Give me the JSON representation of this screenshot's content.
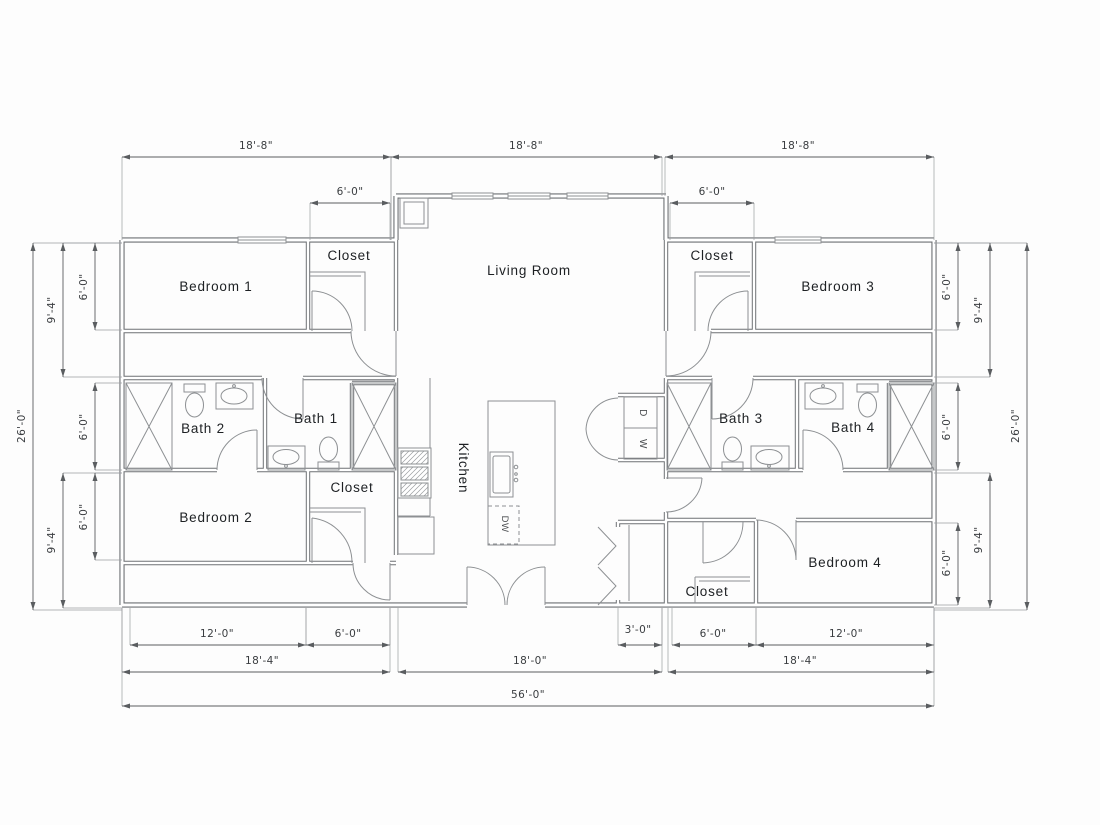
{
  "drawing": {
    "type": "floor-plan",
    "units": "feet-inches",
    "overall_width": "56'-0\"",
    "overall_depth": "26'-0\""
  },
  "colors": {
    "background": "#fdfdfd",
    "wall": "#6e7174",
    "fixture": "#8d9093",
    "door": "#8d9093",
    "dim_line": "#5a5d60",
    "ext_line": "#9a9da0",
    "room_text": "#1d2023",
    "dim_text": "#3a3d40"
  },
  "rooms": [
    {
      "name": "bedroom-1",
      "label": "Bedroom 1",
      "tx": 216,
      "ty": 291,
      "rot": 0
    },
    {
      "name": "closet-bedroom-1",
      "label": "Closet",
      "tx": 349,
      "ty": 260,
      "rot": 0
    },
    {
      "name": "living-room",
      "label": "Living Room",
      "tx": 529,
      "ty": 275,
      "rot": 0
    },
    {
      "name": "closet-bedroom-3",
      "label": "Closet",
      "tx": 712,
      "ty": 260,
      "rot": 0
    },
    {
      "name": "bedroom-3",
      "label": "Bedroom 3",
      "tx": 838,
      "ty": 291,
      "rot": 0
    },
    {
      "name": "bath-2",
      "label": "Bath 2",
      "tx": 203,
      "ty": 433,
      "rot": 0
    },
    {
      "name": "bath-1",
      "label": "Bath 1",
      "tx": 316,
      "ty": 423,
      "rot": 0
    },
    {
      "name": "bath-3",
      "label": "Bath 3",
      "tx": 741,
      "ty": 423,
      "rot": 0
    },
    {
      "name": "bath-4",
      "label": "Bath 4",
      "tx": 853,
      "ty": 432,
      "rot": 0
    },
    {
      "name": "kitchen",
      "label": "Kitchen",
      "tx": 459,
      "ty": 468,
      "rot": 90
    },
    {
      "name": "bedroom-2",
      "label": "Bedroom 2",
      "tx": 216,
      "ty": 522,
      "rot": 0
    },
    {
      "name": "closet-bedroom-2",
      "label": "Closet",
      "tx": 352,
      "ty": 492,
      "rot": 0
    },
    {
      "name": "closet-bedroom-4",
      "label": "Closet",
      "tx": 707,
      "ty": 596,
      "rot": 0
    },
    {
      "name": "bedroom-4",
      "label": "Bedroom 4",
      "tx": 845,
      "ty": 567,
      "rot": 0
    }
  ],
  "appliances": [
    {
      "name": "dryer",
      "label": "D",
      "tx": 640,
      "ty": 413,
      "rot": 90
    },
    {
      "name": "washer",
      "label": "W",
      "tx": 640,
      "ty": 444,
      "rot": 90
    },
    {
      "name": "dishwasher",
      "label": "DW",
      "tx": 502,
      "ty": 524,
      "rot": 90
    }
  ],
  "dimensions": [
    {
      "name": "top-left-wing",
      "label": "18'-8\"",
      "x1": 122,
      "y1": 157,
      "x2": 391,
      "y2": 157,
      "e1": 83,
      "e2": 83,
      "tx": 256,
      "ty": 149,
      "rot": 0
    },
    {
      "name": "top-center",
      "label": "18'-8\"",
      "x1": 391,
      "y1": 157,
      "x2": 662,
      "y2": 157,
      "e1": 83,
      "e2": 39,
      "tx": 526,
      "ty": 149,
      "rot": 0
    },
    {
      "name": "top-right-wing",
      "label": "18'-8\"",
      "x1": 665,
      "y1": 157,
      "x2": 934,
      "y2": 157,
      "e1": 39,
      "e2": 83,
      "tx": 798,
      "ty": 149,
      "rot": 0
    },
    {
      "name": "closet1-width",
      "label": "6'-0\"",
      "x1": 310,
      "y1": 203,
      "x2": 390,
      "y2": 203,
      "e1": 37,
      "e2": 37,
      "tx": 350,
      "ty": 195,
      "rot": 0
    },
    {
      "name": "closet3-width",
      "label": "6'-0\"",
      "x1": 670,
      "y1": 203,
      "x2": 754,
      "y2": 203,
      "e1": 37,
      "e2": 37,
      "tx": 712,
      "ty": 195,
      "rot": 0
    },
    {
      "name": "bedroom2-width",
      "label": "12'-0\"",
      "x1": 130,
      "y1": 645,
      "x2": 306,
      "y2": 645,
      "e1": -37,
      "e2": -37,
      "tx": 217,
      "ty": 637,
      "rot": 0
    },
    {
      "name": "closet2-width",
      "label": "6'-0\"",
      "x1": 306,
      "y1": 645,
      "x2": 390,
      "y2": 645,
      "e1": -37,
      "e2": -37,
      "tx": 348,
      "ty": 637,
      "rot": 0
    },
    {
      "name": "pantry-width",
      "label": "3'-0\"",
      "x1": 618,
      "y1": 645,
      "x2": 662,
      "y2": 645,
      "e1": -37,
      "e2": -37,
      "tx": 638,
      "ty": 633,
      "rot": 0
    },
    {
      "name": "closet4-width",
      "label": "6'-0\"",
      "x1": 672,
      "y1": 645,
      "x2": 756,
      "y2": 645,
      "e1": -37,
      "e2": -37,
      "tx": 713,
      "ty": 637,
      "rot": 0
    },
    {
      "name": "bedroom4-width",
      "label": "12'-0\"",
      "x1": 756,
      "y1": 645,
      "x2": 934,
      "y2": 645,
      "e1": -37,
      "e2": -37,
      "tx": 846,
      "ty": 637,
      "rot": 0
    },
    {
      "name": "left-wing-width",
      "label": "18'-4\"",
      "x1": 122,
      "y1": 672,
      "x2": 390,
      "y2": 672,
      "e1": -64,
      "e2": -64,
      "tx": 262,
      "ty": 664,
      "rot": 0
    },
    {
      "name": "center-width",
      "label": "18'-0\"",
      "x1": 398,
      "y1": 672,
      "x2": 662,
      "y2": 672,
      "e1": -64,
      "e2": -64,
      "tx": 530,
      "ty": 664,
      "rot": 0
    },
    {
      "name": "right-wing-width",
      "label": "18'-4\"",
      "x1": 668,
      "y1": 672,
      "x2": 934,
      "y2": 672,
      "e1": -64,
      "e2": -64,
      "tx": 800,
      "ty": 664,
      "rot": 0
    },
    {
      "name": "overall-width",
      "label": "56'-0\"",
      "x1": 122,
      "y1": 706,
      "x2": 934,
      "y2": 706,
      "e1": -98,
      "e2": -98,
      "tx": 528,
      "ty": 698,
      "rot": 0
    },
    {
      "name": "left-overall",
      "label": "26'-0\"",
      "x1": 33,
      "y1": 243,
      "x2": 33,
      "y2": 610,
      "e1": 89,
      "e2": 89,
      "tx": 25,
      "ty": 426,
      "rot": -90
    },
    {
      "name": "left-94-top",
      "label": "9'-4\"",
      "x1": 63,
      "y1": 243,
      "x2": 63,
      "y2": 377,
      "e1": 59,
      "e2": 59,
      "tx": 55,
      "ty": 310,
      "rot": -90
    },
    {
      "name": "left-60-top",
      "label": "6'-0\"",
      "x1": 95,
      "y1": 243,
      "x2": 95,
      "y2": 330,
      "e1": 27,
      "e2": 27,
      "tx": 87,
      "ty": 287,
      "rot": -90
    },
    {
      "name": "left-60-mid",
      "label": "6'-0\"",
      "x1": 95,
      "y1": 383,
      "x2": 95,
      "y2": 470,
      "e1": 27,
      "e2": 27,
      "tx": 87,
      "ty": 427,
      "rot": -90
    },
    {
      "name": "left-94-bottom",
      "label": "9'-4\"",
      "x1": 63,
      "y1": 473,
      "x2": 63,
      "y2": 608,
      "e1": 59,
      "e2": 59,
      "tx": 55,
      "ty": 540,
      "rot": -90
    },
    {
      "name": "left-60-bottom",
      "label": "6'-0\"",
      "x1": 95,
      "y1": 473,
      "x2": 95,
      "y2": 560,
      "e1": 27,
      "e2": 27,
      "tx": 87,
      "ty": 517,
      "rot": -90
    },
    {
      "name": "right-overall",
      "label": "26'-0\"",
      "x1": 1027,
      "y1": 243,
      "x2": 1027,
      "y2": 610,
      "e1": -93,
      "e2": -93,
      "tx": 1019,
      "ty": 426,
      "rot": -90
    },
    {
      "name": "right-94-top",
      "label": "9'-4\"",
      "x1": 990,
      "y1": 243,
      "x2": 990,
      "y2": 377,
      "e1": -56,
      "e2": -56,
      "tx": 982,
      "ty": 310,
      "rot": -90
    },
    {
      "name": "right-60-top",
      "label": "6'-0\"",
      "x1": 958,
      "y1": 243,
      "x2": 958,
      "y2": 330,
      "e1": -24,
      "e2": -24,
      "tx": 950,
      "ty": 287,
      "rot": -90
    },
    {
      "name": "right-60-mid",
      "label": "6'-0\"",
      "x1": 958,
      "y1": 383,
      "x2": 958,
      "y2": 470,
      "e1": -24,
      "e2": -24,
      "tx": 950,
      "ty": 427,
      "rot": -90
    },
    {
      "name": "right-94-bottom",
      "label": "9'-4\"",
      "x1": 990,
      "y1": 473,
      "x2": 990,
      "y2": 608,
      "e1": -56,
      "e2": -56,
      "tx": 982,
      "ty": 540,
      "rot": -90
    },
    {
      "name": "right-60-bottom",
      "label": "6'-0\"",
      "x1": 958,
      "y1": 523,
      "x2": 958,
      "y2": 605,
      "e1": -24,
      "e2": -24,
      "tx": 950,
      "ty": 563,
      "rot": -90
    }
  ]
}
